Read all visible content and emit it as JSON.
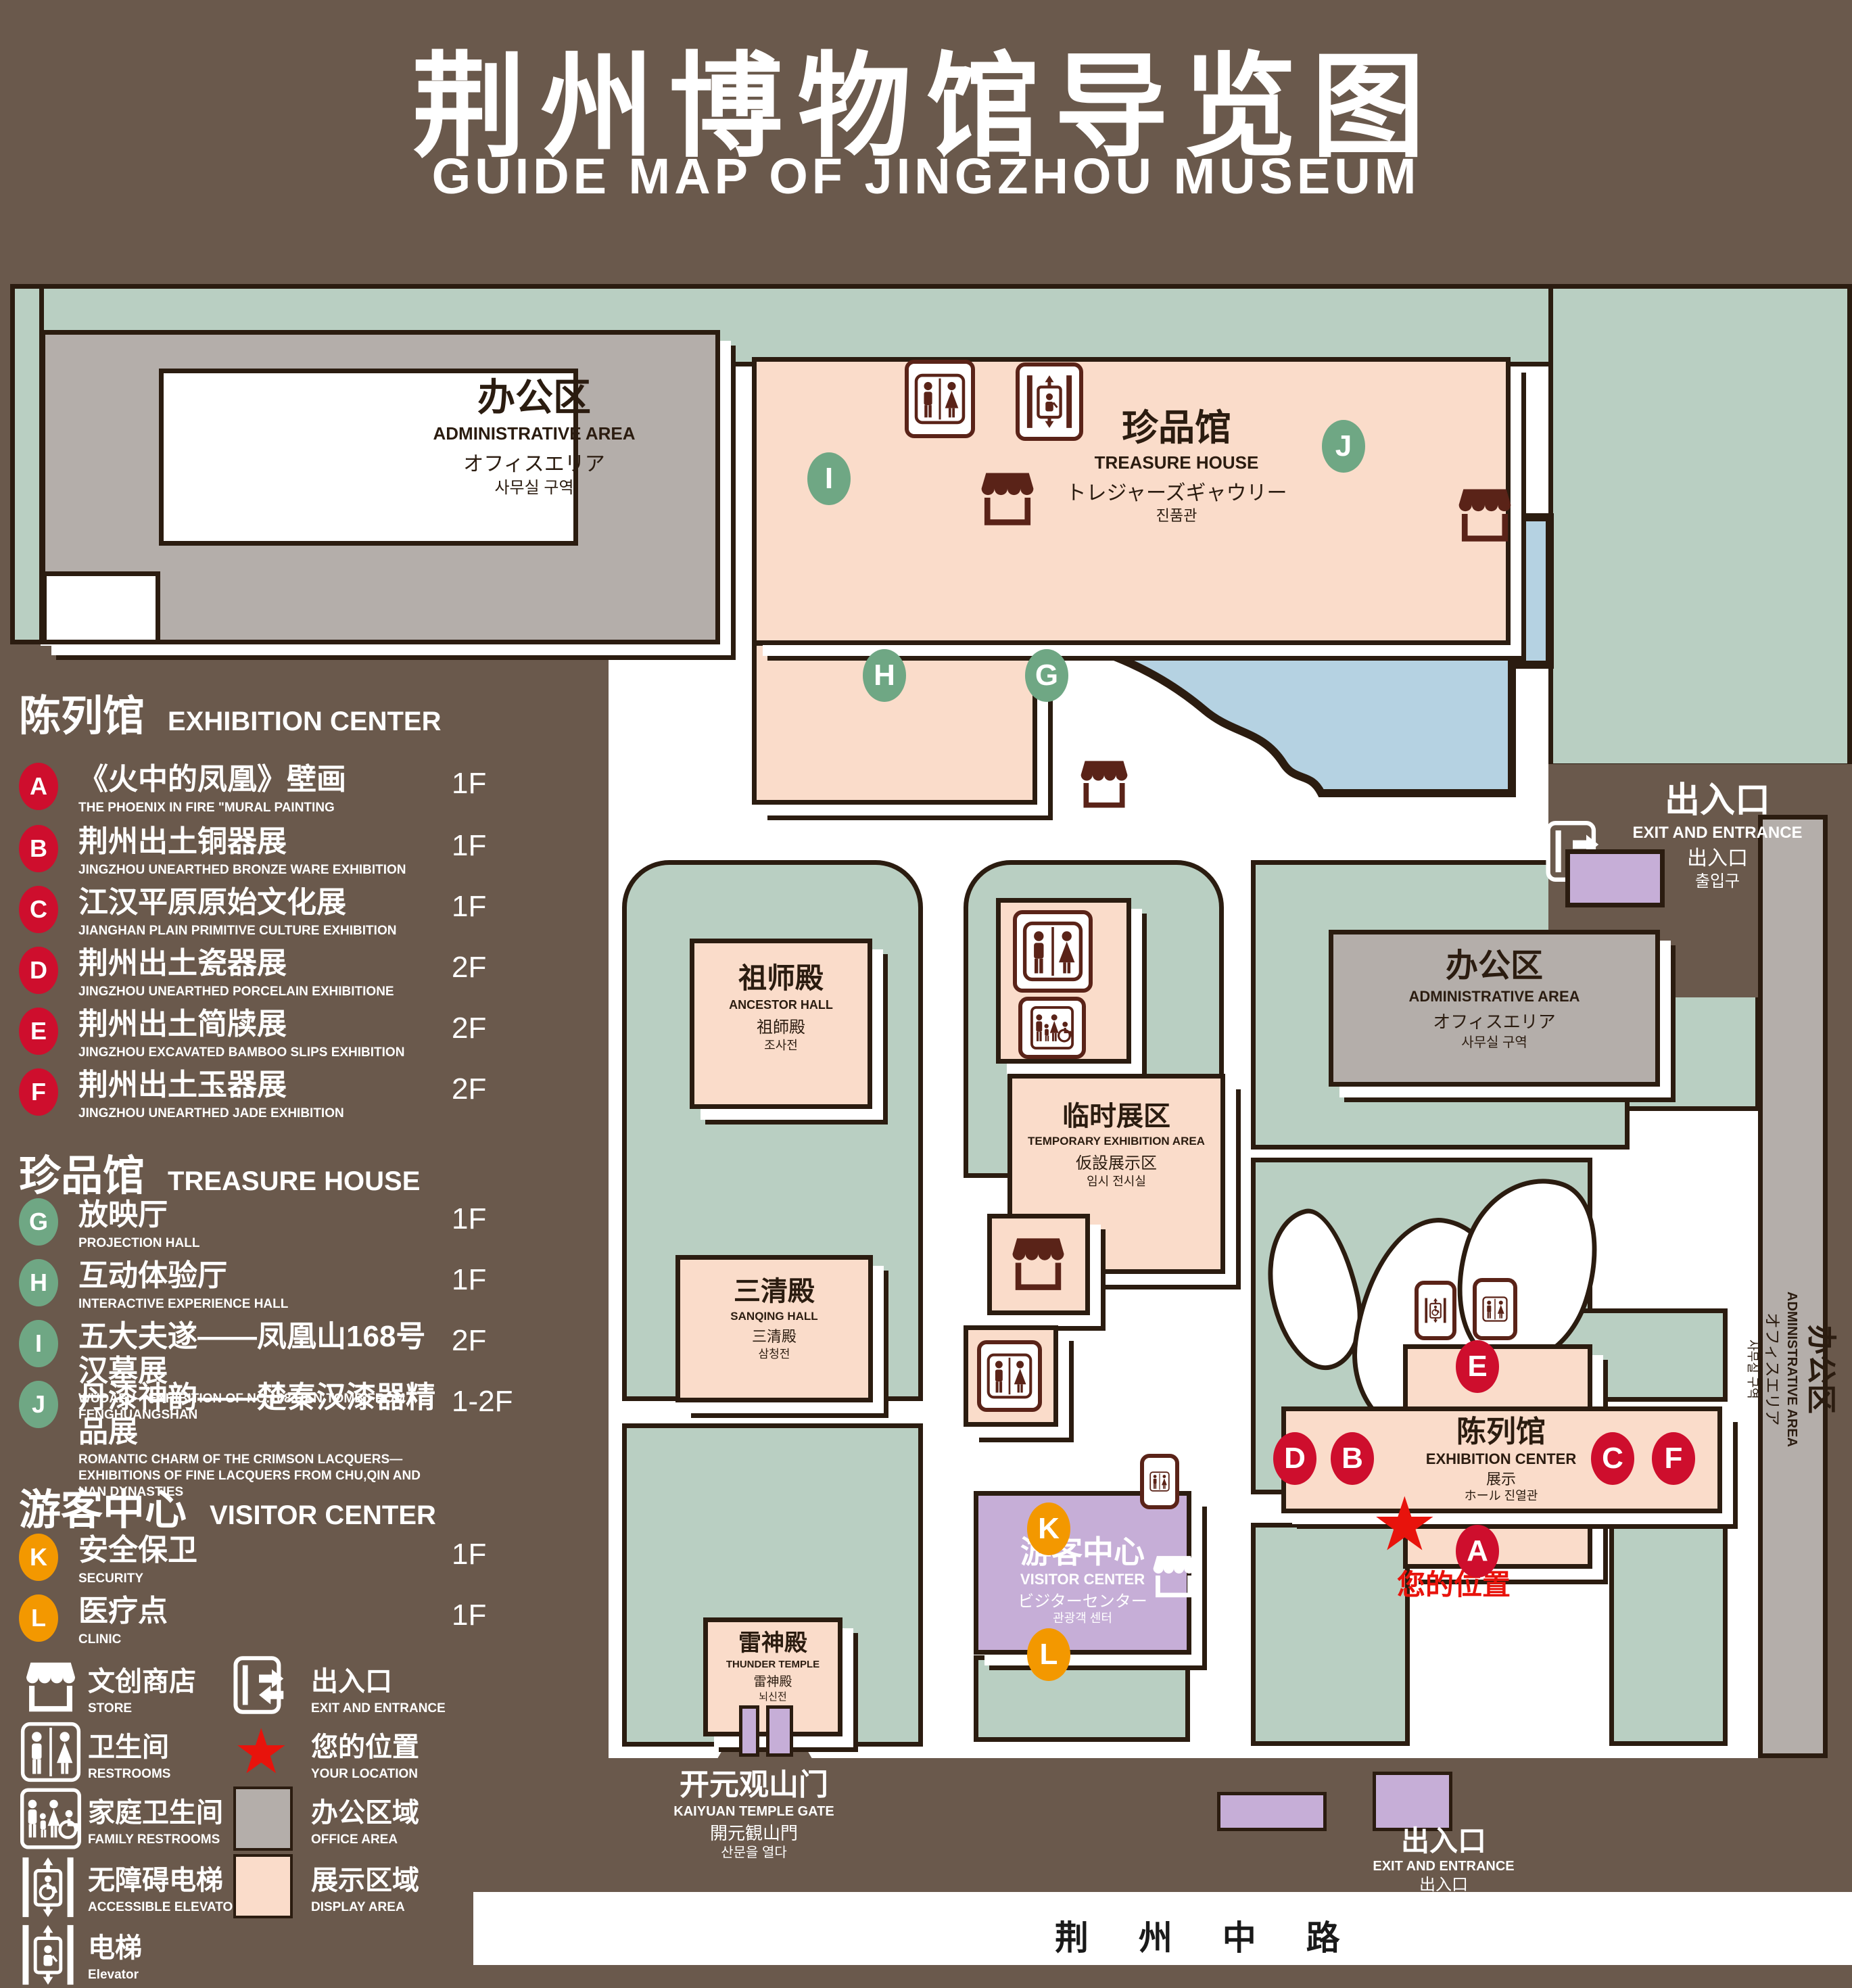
{
  "title": {
    "zh": "荆州博物馆导览图",
    "en": "GUIDE MAP OF JINGZHOU MUSEUM"
  },
  "colors": {
    "bg": "#6a594c",
    "dark": "#2b1c10",
    "green": "#b9cfc2",
    "pink": "#fadcca",
    "gray": "#b4aeaa",
    "purple": "#c6aed7",
    "blue": "#b5d2e2",
    "maroon": "#5a2318",
    "badge-red": "#ce0e2d",
    "badge-green": "#6fa784",
    "badge-orange": "#f39800",
    "star": "#e8130c"
  },
  "icons": {
    "star": "★"
  },
  "legend": {
    "sections": [
      {
        "zh": "陈列馆",
        "en": "EXHIBITION CENTER",
        "items": [
          {
            "key": "A",
            "zh": "《火中的凤凰》壁画",
            "en": "THE PHOENIX IN FIRE \"MURAL PAINTING",
            "floor": "1F"
          },
          {
            "key": "B",
            "zh": "荆州出土铜器展",
            "en": "JINGZHOU UNEARTHED BRONZE WARE EXHIBITION",
            "floor": "1F"
          },
          {
            "key": "C",
            "zh": "江汉平原原始文化展",
            "en": "JIANGHAN PLAIN PRIMITIVE CULTURE EXHIBITION",
            "floor": "1F"
          },
          {
            "key": "D",
            "zh": "荆州出土瓷器展",
            "en": "JINGZHOU UNEARTHED PORCELAIN EXHIBITIONE",
            "floor": "2F"
          },
          {
            "key": "E",
            "zh": "荆州出土简牍展",
            "en": "JINGZHOU EXCAVATED BAMBOO SLIPS EXHIBITION",
            "floor": "2F"
          },
          {
            "key": "F",
            "zh": "荆州出土玉器展",
            "en": "JINGZHOU UNEARTHED JADE EXHIBITION",
            "floor": "2F"
          }
        ]
      },
      {
        "zh": "珍品馆",
        "en": "TREASURE HOUSE",
        "items": [
          {
            "key": "G",
            "zh": "放映厅",
            "en": "PROJECTION HALL",
            "floor": "1F"
          },
          {
            "key": "H",
            "zh": "互动体验厅",
            "en": "INTERACTIVE EXPERIENCE HALL",
            "floor": "1F"
          },
          {
            "key": "I",
            "zh": "五大夫遂——凤凰山168号汉墓展",
            "en": "WUDAFU—EXHIBITION OF NO.168 HAN TOMB FROM FENGHUANGSHAN",
            "floor": "2F"
          },
          {
            "key": "J",
            "zh": "丹漆神韵——楚秦汉漆器精品展",
            "en": "ROMANTIC CHARM OF THE CRIMSON LACQUERS—EXHIBITIONS OF FINE LACQUERS FROM CHU,QIN AND HAN DYNASTIES",
            "floor": "1-2F"
          }
        ]
      },
      {
        "zh": "游客中心",
        "en": "VISITOR CENTER",
        "items": [
          {
            "key": "K",
            "zh": "安全保卫",
            "en": "SECURITY",
            "floor": "1F"
          },
          {
            "key": "L",
            "zh": "医疗点",
            "en": "CLINIC",
            "floor": "1F"
          }
        ]
      }
    ],
    "symbols": [
      {
        "zh": "文创商店",
        "en": "STORE"
      },
      {
        "zh": "出入口",
        "en": "EXIT AND ENTRANCE"
      },
      {
        "zh": "卫生间",
        "en": "RESTROOMS"
      },
      {
        "zh": "您的位置",
        "en": "YOUR LOCATION"
      },
      {
        "zh": "家庭卫生间",
        "en": "FAMILY RESTROOMS"
      },
      {
        "zh": "办公区域",
        "en": "OFFICE AREA"
      },
      {
        "zh": "无障碍电梯",
        "en": "ACCESSIBLE ELEVATOR"
      },
      {
        "zh": "展示区域",
        "en": "DISPLAY AREA"
      },
      {
        "zh": "电梯",
        "en": "Elevator"
      }
    ]
  },
  "map": {
    "admin_nw": {
      "l1": "办公区",
      "l2": "ADMINISTRATIVE AREA",
      "l3": "オフィスエリア",
      "l4": "사무실 구역"
    },
    "treasure": {
      "l1": "珍品馆",
      "l2": "TREASURE HOUSE",
      "l3": "トレジャーズギャウリー",
      "l4": "진품관"
    },
    "ancestor": {
      "l1": "祖师殿",
      "l2": "ANCESTOR HALL",
      "l3": "祖師殿",
      "l4": "조사전"
    },
    "temporary": {
      "l1": "临时展区",
      "l2": "TEMPORARY EXHIBITION AREA",
      "l3": "仮設展示区",
      "l4": "임시 전시실"
    },
    "admin_e": {
      "l1": "办公区",
      "l2": "ADMINISTRATIVE AREA",
      "l3": "オフィスエリア",
      "l4": "사무실 구역"
    },
    "admin_strip": {
      "l1": "办公区",
      "l2": "ADMINISTRATIVE AREA",
      "l3": "オフィスエリア",
      "l4": "사무실 구역"
    },
    "sanqing": {
      "l1": "三清殿",
      "l2": "SANQING HALL",
      "l3": "三清殿",
      "l4": "삼청전"
    },
    "thunder": {
      "l1": "雷神殿",
      "l2": "THUNDER TEMPLE",
      "l3": "雷神殿",
      "l4": "뇌신전"
    },
    "visitor": {
      "l1": "游客中心",
      "l2": "VISITOR CENTER",
      "l3": "ビジターセンター",
      "l4": "관광객 센터"
    },
    "exhibition": {
      "l1": "陈列馆",
      "l2": "EXHIBITION CENTER",
      "l3": "展示",
      "l4": "ホール 진열관"
    },
    "gate": {
      "l1": "开元观山门",
      "l2": "KAIYUAN TEMPLE GATE",
      "l3": "開元観山門",
      "l4": "산문을 열다"
    },
    "exit_ne": {
      "l1": "出入口",
      "l2": "EXIT AND ENTRANCE",
      "l3": "出入口",
      "l4": "출입구"
    },
    "exit_s": {
      "l1": "出入口",
      "l2": "EXIT AND ENTRANCE",
      "l3": "出入口",
      "l4": "출입구"
    },
    "road": "荆 州 中 路",
    "your_location": "您的位置",
    "badges": [
      "A",
      "B",
      "C",
      "D",
      "E",
      "F",
      "G",
      "H",
      "I",
      "J",
      "K",
      "L"
    ]
  }
}
